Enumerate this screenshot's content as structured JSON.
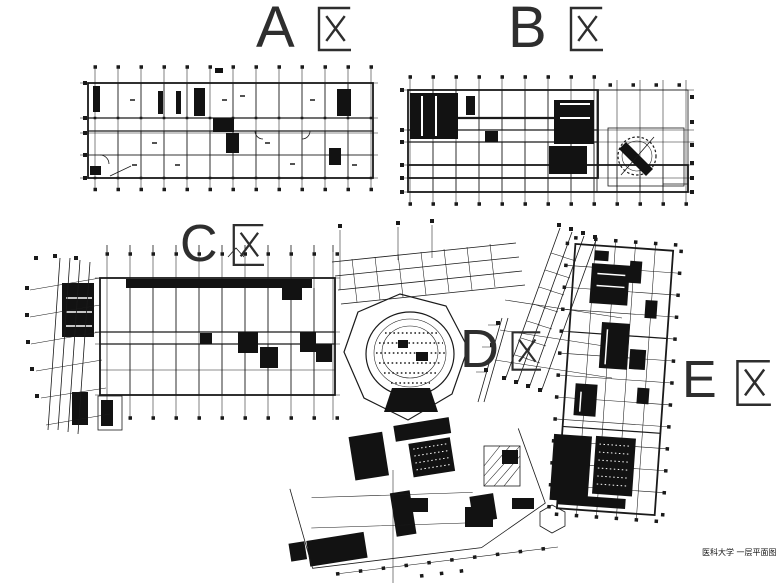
{
  "zones": [
    {
      "letter": "A",
      "name": "A区"
    },
    {
      "letter": "B",
      "name": "B区"
    },
    {
      "letter": "C",
      "name": "C区"
    },
    {
      "letter": "D",
      "name": "D区"
    },
    {
      "letter": "E",
      "name": "E区"
    }
  ],
  "footer": {
    "title": "医科大学 一层平面图"
  },
  "colors": {
    "ink": "#1a1a1a",
    "paper": "#ffffff"
  }
}
